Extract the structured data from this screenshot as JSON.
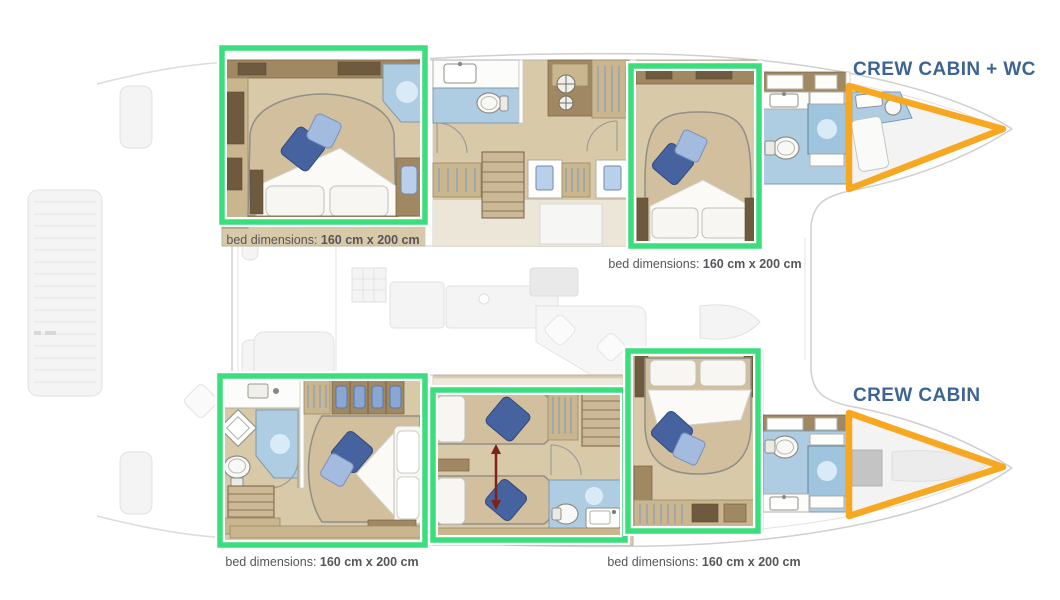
{
  "colors": {
    "highlight-green": "#3ade7c",
    "highlight-orange": "#f7a820",
    "label-blue": "#3e6494",
    "caption-gray": "#55565a"
  },
  "crew": {
    "top_label": "CREW CABIN + WC",
    "bottom_label": "CREW CABIN"
  },
  "captions": [
    {
      "prefix": "bed dimensions:",
      "value": "160 cm x 200 cm"
    },
    {
      "prefix": "bed dimensions:",
      "value": "160 cm x 200 cm"
    },
    {
      "prefix": "bed dimensions:",
      "value": "160 cm x 200 cm"
    },
    {
      "prefix": "bed dimensions:",
      "value": "160 cm x 200 cm"
    }
  ]
}
